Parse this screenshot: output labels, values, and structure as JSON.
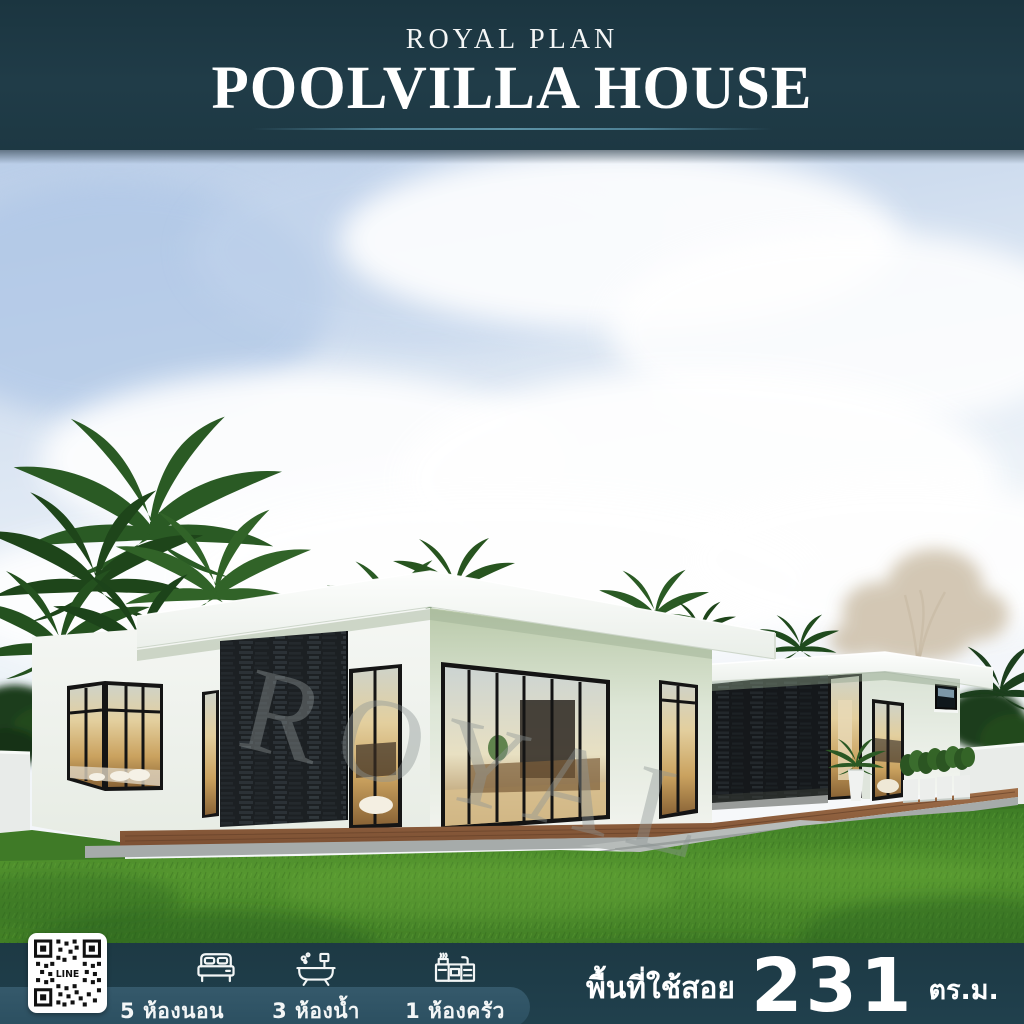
{
  "header": {
    "brand": "ROYAL PLAN",
    "title": "POOLVILLA HOUSE"
  },
  "scene": {
    "watermark": "ROYAL"
  },
  "footer": {
    "qr_label": "LINE",
    "features": [
      {
        "icon": "bed-icon",
        "label": "5 ห้องนอน"
      },
      {
        "icon": "bathtub-icon",
        "label": "3 ห้องน้ำ"
      },
      {
        "icon": "kitchen-icon",
        "label": "1 ห้องครัว"
      }
    ],
    "area": {
      "label": "พื้นที่ใช้สอย",
      "value": "231",
      "unit": "ตร.ม."
    }
  },
  "colors": {
    "banner_bg": "#1f3a46",
    "pill_bg": "#2e5363",
    "underline": "#4d7f93",
    "text": "#ffffff",
    "lawn_green": "#4c8f2b",
    "stone_dark": "#1c2023"
  }
}
